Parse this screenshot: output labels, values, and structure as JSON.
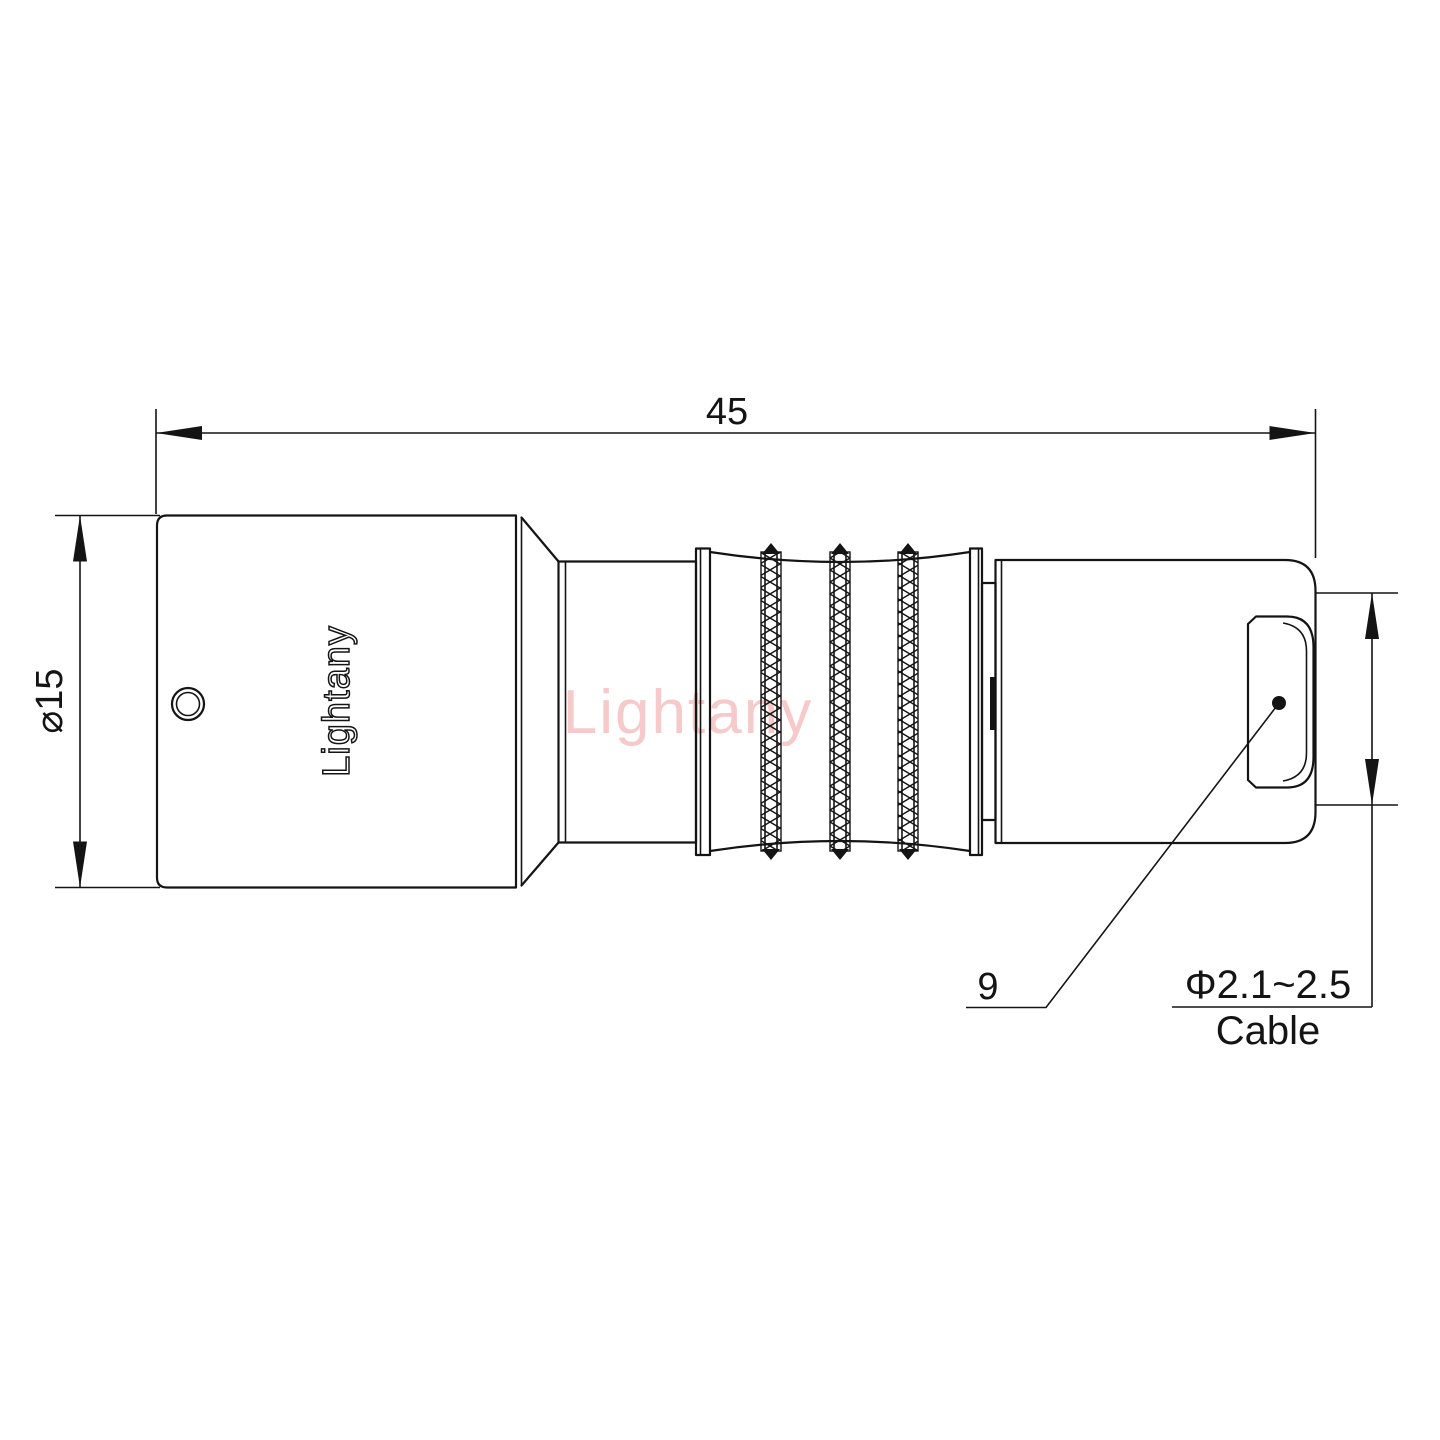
{
  "page": {
    "background_color": "#ffffff"
  },
  "drawing": {
    "kind": "technical drawing - circular push-pull connector, side view",
    "watermark_text": "Lightany",
    "engraved_brand": "Lightany",
    "ink_color": "#141414",
    "watermark_color": "#f6caca",
    "dimensions": {
      "overall_length": "45",
      "body_diameter": "⌀15",
      "callout": "9",
      "cable_diameter_range": "Φ2.1~2.5",
      "cable_word": "Cable"
    }
  }
}
